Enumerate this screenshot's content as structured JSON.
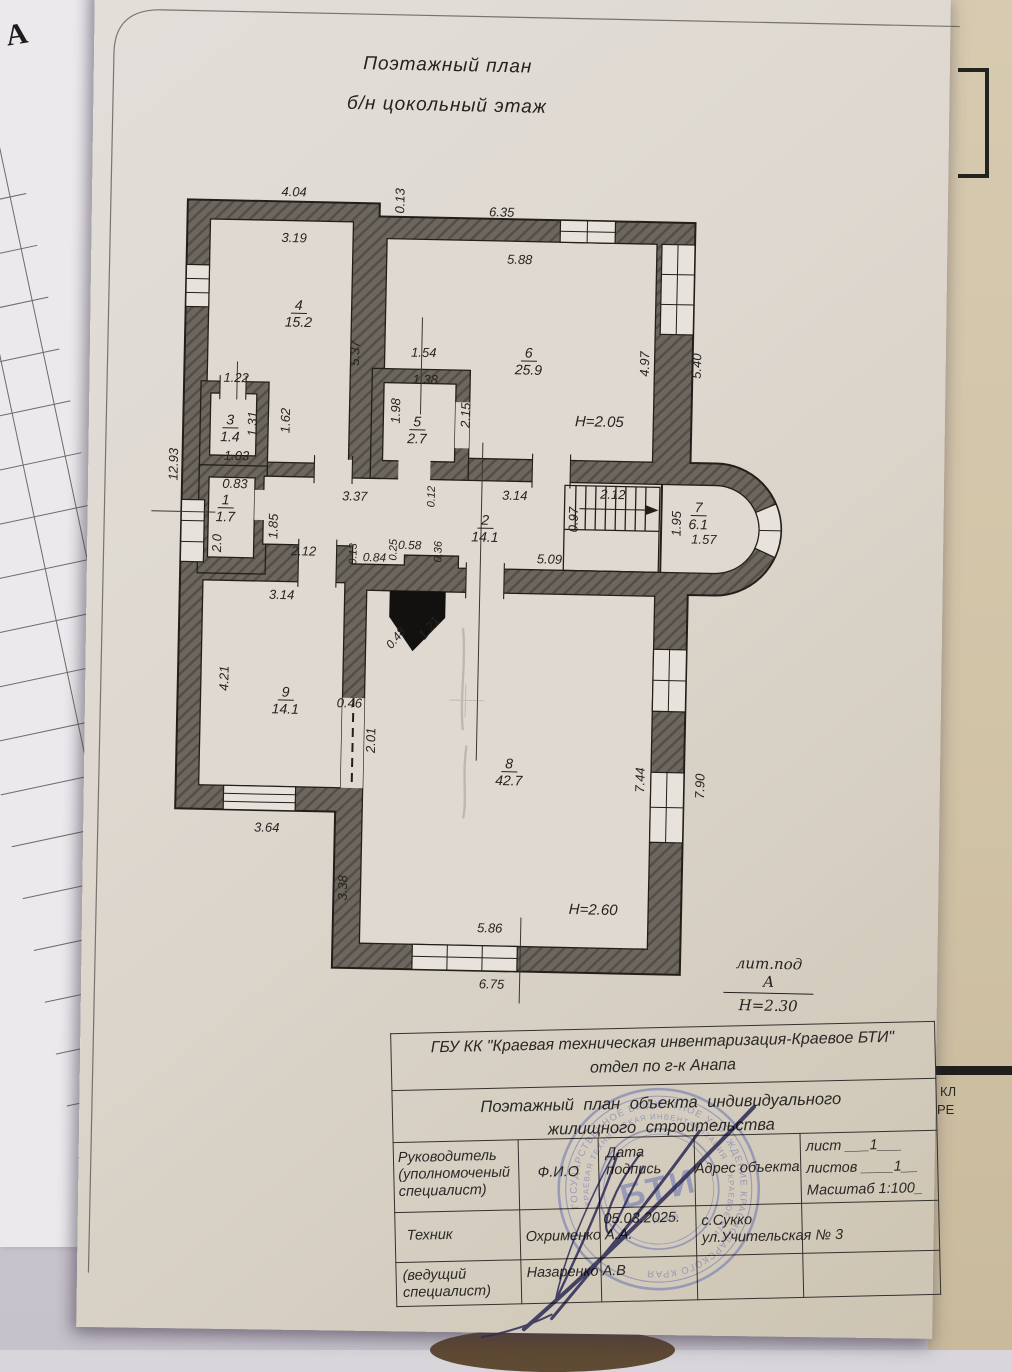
{
  "page": {
    "title_line1": "Поэтажный план",
    "title_line2": "б/н цокольный этаж"
  },
  "left_page": {
    "corner_letter": "А",
    "col_area_header": "ванная площадь, кв. м",
    "col_note_header": "Примечание",
    "col_number": "13"
  },
  "right_page": {
    "partial_text_1": "КЛ",
    "partial_text_2": "РЕ"
  },
  "plan": {
    "rooms": [
      {
        "n": "4",
        "a": "15.2",
        "x": 293,
        "y": 300
      },
      {
        "n": "6",
        "a": "25.9",
        "x": 524,
        "y": 343
      },
      {
        "n": "5",
        "a": "2.7",
        "x": 414,
        "y": 414
      },
      {
        "n": "3",
        "a": "1.4",
        "x": 227,
        "y": 416
      },
      {
        "n": "1",
        "a": "1.7",
        "x": 224,
        "y": 496
      },
      {
        "n": "2",
        "a": "14.1",
        "x": 484,
        "y": 511
      },
      {
        "n": "7",
        "a": "6.1",
        "x": 697,
        "y": 494
      },
      {
        "n": "9",
        "a": "14.1",
        "x": 288,
        "y": 687
      },
      {
        "n": "8",
        "a": "42.7",
        "x": 513,
        "y": 754
      }
    ],
    "dimensions": [
      {
        "t": "4.04",
        "x": 286,
        "y": 195
      },
      {
        "t": "0.13",
        "x": 392,
        "y": 202,
        "r": -90
      },
      {
        "t": "6.35",
        "x": 494,
        "y": 211
      },
      {
        "t": "3.19",
        "x": 287,
        "y": 241
      },
      {
        "t": "5.88",
        "x": 513,
        "y": 258
      },
      {
        "t": "5.37",
        "x": 350,
        "y": 355,
        "r": -90
      },
      {
        "t": "1.54",
        "x": 419,
        "y": 353
      },
      {
        "t": "1.38",
        "x": 421,
        "y": 380
      },
      {
        "t": "4.97",
        "x": 640,
        "y": 360,
        "r": -90
      },
      {
        "t": "5.40",
        "x": 692,
        "y": 361,
        "r": -90
      },
      {
        "t": "1.22",
        "x": 232,
        "y": 382
      },
      {
        "t": "1.98",
        "x": 392,
        "y": 412,
        "r": -90
      },
      {
        "t": "2.15",
        "x": 462,
        "y": 415,
        "r": -90
      },
      {
        "t": "1.31",
        "x": 249,
        "y": 428,
        "r": -90
      },
      {
        "t": "1.62",
        "x": 282,
        "y": 424,
        "r": -90
      },
      {
        "t": "1.03",
        "x": 234,
        "y": 460
      },
      {
        "t": "12.93",
        "x": 171,
        "y": 470,
        "r": -90
      },
      {
        "t": "0.83",
        "x": 233,
        "y": 488
      },
      {
        "t": "3.37",
        "x": 353,
        "y": 498
      },
      {
        "t": "0.12",
        "x": 430,
        "y": 497,
        "r": -90,
        "s": 11
      },
      {
        "t": "3.14",
        "x": 513,
        "y": 494
      },
      {
        "t": "2.12",
        "x": 611,
        "y": 491
      },
      {
        "t": "0.97",
        "x": 572,
        "y": 517,
        "r": -90
      },
      {
        "t": "1.95",
        "x": 675,
        "y": 519,
        "r": -90
      },
      {
        "t": "1.57",
        "x": 703,
        "y": 534
      },
      {
        "t": "1.85",
        "x": 272,
        "y": 530,
        "r": -90
      },
      {
        "t": "2.0",
        "x": 216,
        "y": 548,
        "r": -90
      },
      {
        "t": "2.12",
        "x": 303,
        "y": 554
      },
      {
        "t": "0.13",
        "x": 353,
        "y": 556,
        "r": -90,
        "s": 11
      },
      {
        "t": "0.84",
        "x": 374,
        "y": 559,
        "s": 12
      },
      {
        "t": "0.25",
        "x": 393,
        "y": 551,
        "r": -90,
        "s": 11
      },
      {
        "t": "0.58",
        "x": 409,
        "y": 546,
        "s": 12
      },
      {
        "t": "0.36",
        "x": 438,
        "y": 552,
        "r": -90,
        "s": 11
      },
      {
        "t": "5.09",
        "x": 549,
        "y": 557
      },
      {
        "t": "3.14",
        "x": 282,
        "y": 598
      },
      {
        "t": "0.48",
        "x": 397,
        "y": 639,
        "r": -52,
        "s": 12
      },
      {
        "t": "1.21",
        "x": 430,
        "y": 628,
        "r": -52
      },
      {
        "t": "4.21",
        "x": 226,
        "y": 683,
        "r": -90
      },
      {
        "t": "0.46",
        "x": 352,
        "y": 705
      },
      {
        "t": "2.01",
        "x": 374,
        "y": 742,
        "r": -90
      },
      {
        "t": "7.44",
        "x": 644,
        "y": 776,
        "r": -90
      },
      {
        "t": "7.90",
        "x": 704,
        "y": 781,
        "r": -90
      },
      {
        "t": "3.64",
        "x": 272,
        "y": 831
      },
      {
        "t": "3.38",
        "x": 349,
        "y": 890,
        "r": -90
      },
      {
        "t": "5.86",
        "x": 497,
        "y": 927
      },
      {
        "t": "6.75",
        "x": 500,
        "y": 983
      },
      {
        "t": "H=2.05",
        "x": 596,
        "y": 419,
        "s": 15
      },
      {
        "t": "H=2.60",
        "x": 600,
        "y": 907,
        "s": 15
      }
    ],
    "litera": {
      "top": "лит.под  А",
      "bottom": "H=2.30"
    }
  },
  "title_block": {
    "org_line1": "ГБУ КК \"Краевая техническая инвентаризация-Краевое БТИ\"",
    "org_line2": "отдел по г-к Анапа",
    "doc_line1": "Поэтажный  план  объекта  индивидуального",
    "doc_line2": "жилищного строительства",
    "head_role": "Руководитель\n(уполномоченый\nспециалист)",
    "head_fio": "Ф.И.О",
    "head_date": "Дата\nподпись",
    "head_address": "Адрес объекта",
    "sheet_line1": "лист ___1___",
    "sheet_line2": "листов ____1__",
    "sheet_line3": "Масштаб 1:100_",
    "row_tech_role": "Техник",
    "row_tech_fio": "Охрименко А.А.",
    "row_tech_date": "05.03.2025.",
    "row_tech_address": "с.Сукко\nул.Учительская № 3",
    "row_lead_role": "(ведущий\nспециалист)",
    "row_lead_fio": "Назаренко А.В"
  },
  "stamp": {
    "ring1": "ГОСУДАРСТВЕННОЕ БЮДЖЕТНОЕ УЧРЕЖДЕНИЕ КРАСНОДАРСКОГО КРАЯ",
    "ring2": "КРАЕВАЯ ТЕХНИЧЕСКАЯ ИНВЕНТАРИЗАЦИЯ — КРАЕВОЕ БТИ",
    "center": "БТИ",
    "sub": "Анапа"
  },
  "colors": {
    "wall": "#6b665e",
    "paper": "#dfd9d1",
    "stamp_ink": "#7d82b4",
    "signature_ink": "#302e58"
  }
}
